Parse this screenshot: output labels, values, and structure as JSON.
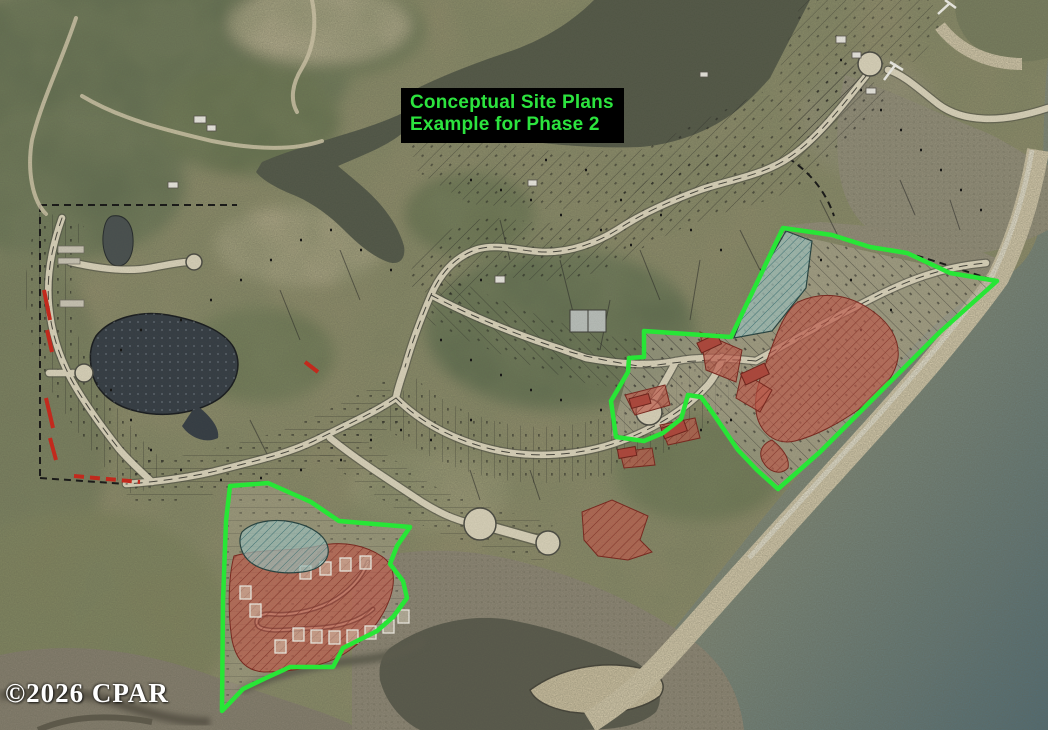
{
  "map": {
    "annotation": {
      "line1": "Conceptual Site Plans",
      "line2": "Example for Phase 2",
      "text_color": "#2ce43e",
      "bg_color": "#000000"
    },
    "watermark": {
      "text": "©2026 CPAR",
      "color": "#ffffff"
    },
    "overlay_colors": {
      "phase_outline": "#27e636",
      "highlighted_lots": "#c4584a",
      "wetland_hatch": "#9fc4bf",
      "road": "#d9d2ba",
      "parcel_line": "#1a1a1a",
      "red_marks": "#cc2418"
    },
    "layers": [
      "aerial-imagery",
      "water",
      "marsh",
      "beach",
      "parcel-lines",
      "roads",
      "highlighted-lots",
      "wetland-areas",
      "phase-2-outlines",
      "annotation-label",
      "watermark"
    ]
  }
}
